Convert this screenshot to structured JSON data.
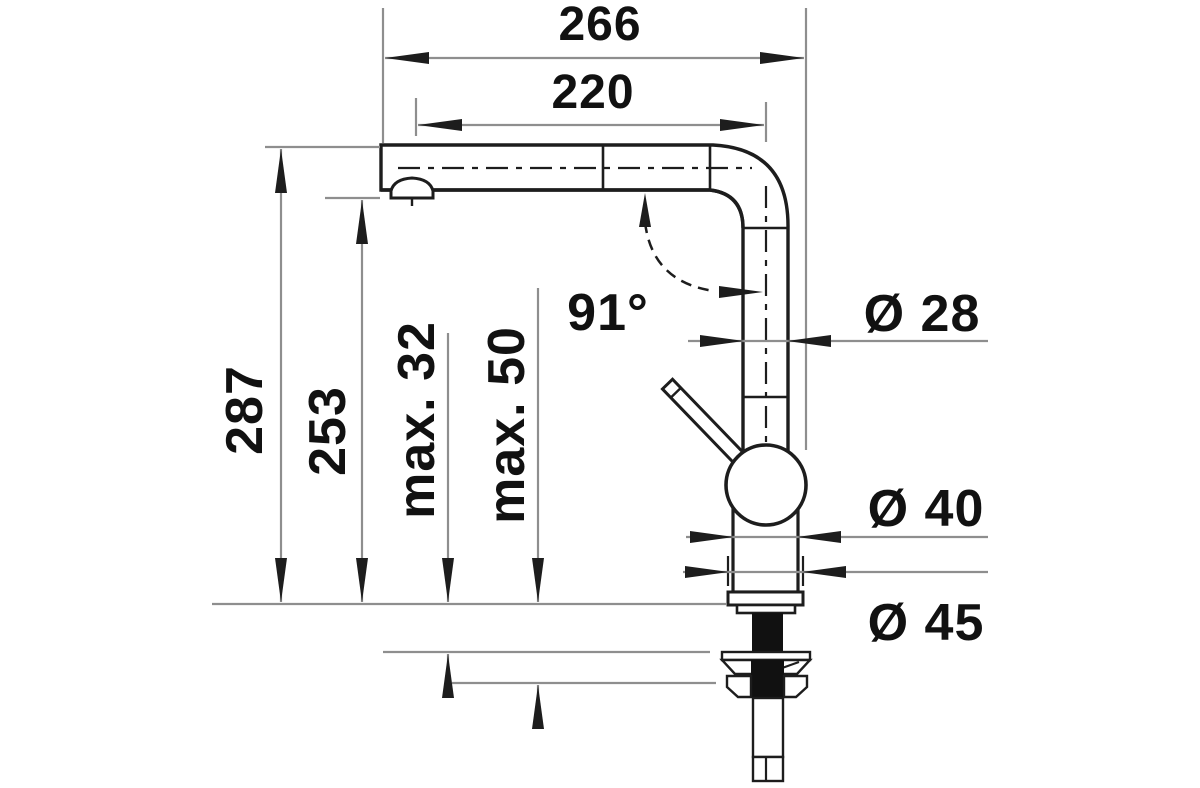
{
  "meta": {
    "type": "technical-drawing",
    "subject": "kitchen-faucet-side-elevation-with-dimensions"
  },
  "labels": {
    "overall_width": "266",
    "spout_reach": "220",
    "overall_height": "287",
    "outlet_height": "253",
    "max_thickness_counter": "max. 32",
    "max_thickness_deck": "max. 50",
    "spout_angle": "91°",
    "spout_tube_diameter": "Ø 28",
    "body_diameter": "Ø 40",
    "base_diameter": "Ø 45"
  },
  "colors": {
    "object_line": "#1d1d1d",
    "dimension_line": "#8e8e8e",
    "text": "#111111",
    "background": "#ffffff"
  }
}
